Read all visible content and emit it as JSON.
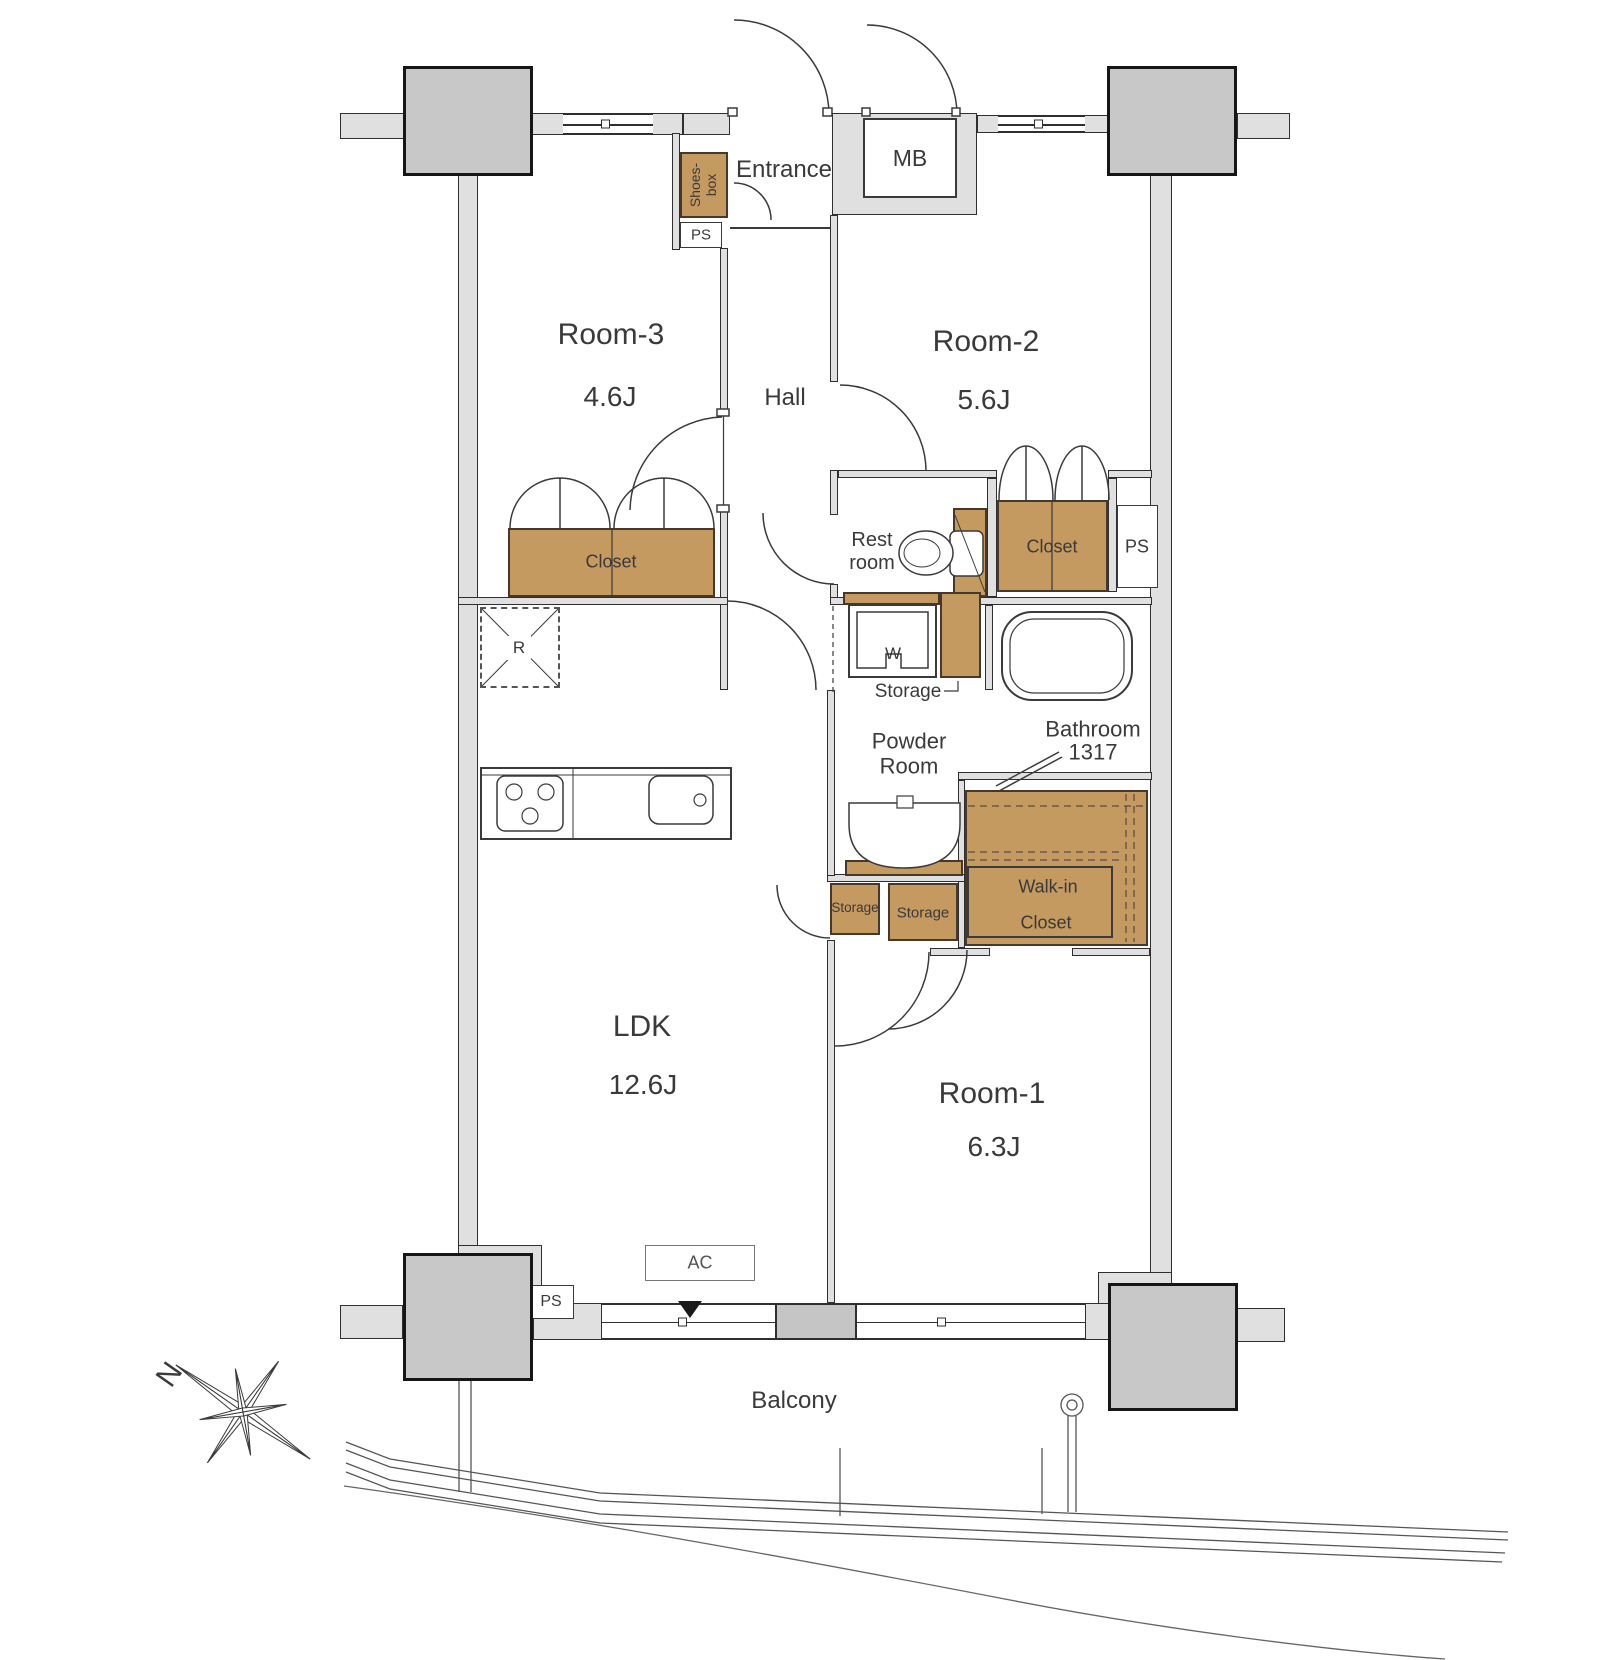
{
  "floorplan": {
    "title_hint": "apartment floor plan",
    "labels": {
      "entrance": "Entrance",
      "mb": "MB",
      "shoes_line1": "Shoes-",
      "shoes_line2": "box",
      "ps": "PS",
      "room3_name": "Room-3",
      "room3_size": "4.6J",
      "hall": "Hall",
      "room2_name": "Room-2",
      "room2_size": "5.6J",
      "rest_line1": "Rest",
      "rest_line2": "room",
      "closet": "Closet",
      "bathroom_name": "Bathroom",
      "bathroom_size": "1317",
      "washer": "W",
      "storage": "Storage",
      "powder_line1": "Powder",
      "powder_line2": "Room",
      "wic_line1": "Walk-in",
      "wic_line2": "Closet",
      "ldk_name": "LDK",
      "ldk_size": "12.6J",
      "room1_name": "Room-1",
      "room1_size": "6.3J",
      "fridge": "R",
      "ac": "AC",
      "balcony": "Balcony",
      "compass_n": "N"
    },
    "rooms": [
      {
        "name": "LDK",
        "size": "12.6J"
      },
      {
        "name": "Room-1",
        "size": "6.3J"
      },
      {
        "name": "Room-2",
        "size": "5.6J"
      },
      {
        "name": "Room-3",
        "size": "4.6J"
      },
      {
        "name": "Bathroom",
        "size": "1317"
      }
    ],
    "colors": {
      "cabinet_tan": "#C49A60",
      "wall_gray": "#E0E0E0",
      "pillar_gray": "#C8C8C8",
      "line": "#3a3a3a"
    }
  }
}
